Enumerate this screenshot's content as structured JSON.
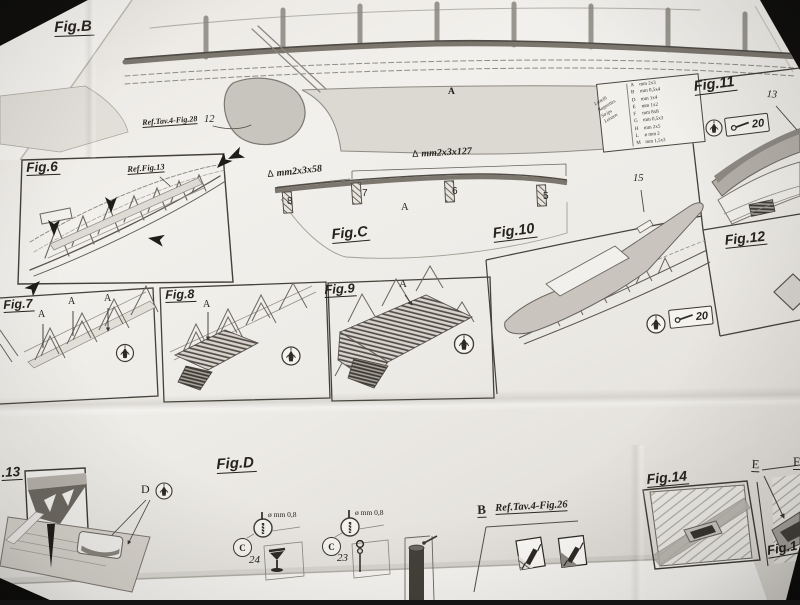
{
  "scene": {
    "description": "Photograph of a model-ship instruction plan sheet",
    "background_color": "#141414",
    "paper_color": "#edeae6"
  },
  "top_section": {
    "fig_b_title": "Fig.B",
    "ref_label": "Ref.Tav.4-Fig.28",
    "ref_part_number": "12",
    "zone_letter": "A"
  },
  "parts_table": {
    "side_labels": [
      "Listelli",
      "Baguettes",
      "Strips",
      "Leisten"
    ],
    "rows": [
      {
        "letter": "A",
        "size": "mm 2x3"
      },
      {
        "letter": "B",
        "size": "mm 0,5x4"
      },
      {
        "letter": "D",
        "size": "mm 1x4"
      },
      {
        "letter": "E",
        "size": "mm 1x2"
      },
      {
        "letter": "F",
        "size": "mm 8x8"
      },
      {
        "letter": "G",
        "size": "mm 0,5x3"
      },
      {
        "letter": "H",
        "size": "mm 2x5"
      },
      {
        "letter": "L",
        "size": "ø mm 2"
      },
      {
        "letter": "M",
        "size": "mm 1,5x3"
      }
    ]
  },
  "fig11": {
    "title": "Fig.11",
    "part_number": "13",
    "nail_number": "20"
  },
  "fig12": {
    "title": "Fig.12"
  },
  "fig6": {
    "title": "Fig.6",
    "ref_label": "Ref.Fig.13"
  },
  "figC": {
    "title": "Fig.C",
    "triangle_marker": "Δ",
    "dim_short": "mm2x3x58",
    "dim_long": "mm2x3x127",
    "zone_letter": "A",
    "block_numbers": [
      "8",
      "7",
      "6",
      "5"
    ]
  },
  "fig10": {
    "title": "Fig.10",
    "part_number": "15",
    "nail_number": "20"
  },
  "fig7": {
    "title": "Fig.7",
    "strip_letters": [
      "A",
      "A",
      "A"
    ]
  },
  "fig8": {
    "title": "Fig.8",
    "strip_letter": "A"
  },
  "fig9": {
    "title": "Fig.9",
    "strip_letter": "A"
  },
  "fig13": {
    "title_partial": ".13",
    "part_letter": "D"
  },
  "figD": {
    "title": "Fig.D",
    "drill_label": "ø mm 0,8",
    "glue_letter": "C",
    "part_numbers": [
      "24",
      "23"
    ]
  },
  "refB": {
    "letter": "B",
    "ref_label": "Ref.Tav.4-Fig.26"
  },
  "fig14": {
    "title": "Fig.14"
  },
  "fig15": {
    "title_partial": "Fig.1",
    "part_letter": "E",
    "edge_letter": "F"
  }
}
